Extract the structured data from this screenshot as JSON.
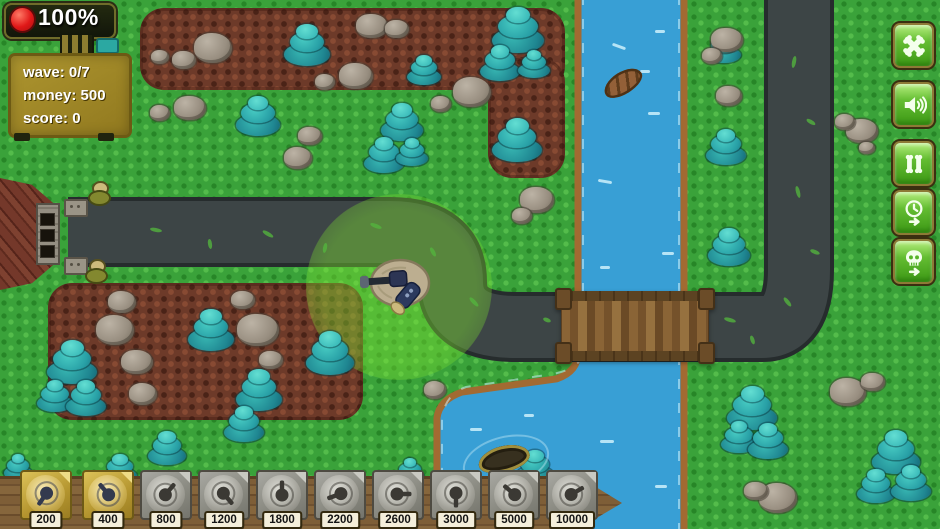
{
  "hud": {
    "health": "100%",
    "stats": [
      "wave: 0/7",
      "money: 500",
      "score: 0"
    ]
  },
  "controls": [
    {
      "id": "settings"
    },
    {
      "id": "sound"
    },
    {
      "id": "pause"
    },
    {
      "id": "fast-forward"
    },
    {
      "id": "next-wave"
    }
  ],
  "shop": {
    "items": [
      {
        "price": "200",
        "affordable": true
      },
      {
        "price": "400",
        "affordable": true
      },
      {
        "price": "800",
        "affordable": false
      },
      {
        "price": "1200",
        "affordable": false
      },
      {
        "price": "1800",
        "affordable": false
      },
      {
        "price": "2200",
        "affordable": false
      },
      {
        "price": "2600",
        "affordable": false
      },
      {
        "price": "3000",
        "affordable": false
      },
      {
        "price": "5000",
        "affordable": false
      },
      {
        "price": "10000",
        "affordable": false
      }
    ]
  },
  "map": {
    "trees": [
      [
        307,
        45,
        46
      ],
      [
        424,
        70,
        34
      ],
      [
        518,
        30,
        52
      ],
      [
        500,
        63,
        40
      ],
      [
        534,
        64,
        32
      ],
      [
        517,
        140,
        50
      ],
      [
        258,
        116,
        44
      ],
      [
        402,
        122,
        42
      ],
      [
        384,
        155,
        40
      ],
      [
        412,
        152,
        32
      ],
      [
        724,
        48,
        34
      ],
      [
        726,
        147,
        40
      ],
      [
        729,
        247,
        42
      ],
      [
        72,
        362,
        50
      ],
      [
        55,
        396,
        36
      ],
      [
        86,
        398,
        40
      ],
      [
        211,
        330,
        46
      ],
      [
        259,
        390,
        46
      ],
      [
        244,
        424,
        40
      ],
      [
        330,
        353,
        48
      ],
      [
        167,
        448,
        38
      ],
      [
        752,
        408,
        50
      ],
      [
        739,
        437,
        36
      ],
      [
        768,
        441,
        40
      ],
      [
        896,
        452,
        48
      ],
      [
        876,
        486,
        38
      ],
      [
        911,
        483,
        40
      ],
      [
        120,
        469,
        34
      ],
      [
        18,
        467,
        28
      ],
      [
        410,
        471,
        28
      ],
      [
        535,
        467,
        38
      ]
    ],
    "rocks": [
      [
        213,
        48,
        38
      ],
      [
        184,
        60,
        24
      ],
      [
        160,
        57,
        18
      ],
      [
        372,
        26,
        32
      ],
      [
        397,
        29,
        24
      ],
      [
        356,
        76,
        34
      ],
      [
        325,
        82,
        20
      ],
      [
        472,
        92,
        38
      ],
      [
        441,
        104,
        20
      ],
      [
        190,
        108,
        32
      ],
      [
        160,
        113,
        20
      ],
      [
        310,
        136,
        24
      ],
      [
        298,
        158,
        28
      ],
      [
        122,
        302,
        28
      ],
      [
        115,
        330,
        38
      ],
      [
        137,
        362,
        32
      ],
      [
        143,
        394,
        28
      ],
      [
        258,
        330,
        42
      ],
      [
        271,
        360,
        24
      ],
      [
        243,
        300,
        24
      ],
      [
        727,
        40,
        32
      ],
      [
        712,
        56,
        20
      ],
      [
        729,
        96,
        26
      ],
      [
        862,
        131,
        32
      ],
      [
        845,
        122,
        20
      ],
      [
        867,
        148,
        16
      ],
      [
        537,
        200,
        34
      ],
      [
        522,
        216,
        20
      ],
      [
        435,
        390,
        22
      ],
      [
        848,
        392,
        36
      ],
      [
        873,
        382,
        24
      ],
      [
        778,
        498,
        38
      ],
      [
        756,
        491,
        24
      ]
    ],
    "road_marks": [
      [
        150,
        228,
        12,
        10
      ],
      [
        205,
        242,
        10,
        80
      ],
      [
        262,
        232,
        12,
        30
      ],
      [
        320,
        246,
        10,
        100
      ],
      [
        370,
        224,
        12,
        20
      ],
      [
        428,
        250,
        10,
        60
      ],
      [
        468,
        300,
        12,
        45
      ],
      [
        543,
        318,
        8,
        20
      ],
      [
        724,
        318,
        12,
        15
      ],
      [
        748,
        338,
        9,
        70
      ],
      [
        788,
        60,
        12,
        100
      ],
      [
        806,
        120,
        10,
        30
      ],
      [
        792,
        190,
        12,
        75
      ],
      [
        810,
        250,
        10,
        20
      ],
      [
        782,
        300,
        11,
        50
      ]
    ],
    "water_dashes": [
      [
        612,
        45,
        14,
        20
      ],
      [
        648,
        112,
        12,
        0
      ],
      [
        598,
        180,
        14,
        10
      ],
      [
        662,
        252,
        12,
        0
      ],
      [
        600,
        266,
        10,
        0
      ],
      [
        640,
        70,
        10,
        0
      ],
      [
        655,
        30,
        10,
        0
      ],
      [
        470,
        428,
        12,
        0
      ],
      [
        524,
        414,
        10,
        0
      ],
      [
        600,
        440,
        14,
        0
      ],
      [
        655,
        485,
        12,
        0
      ],
      [
        590,
        502,
        10,
        0
      ]
    ]
  },
  "colors": {
    "grass": "#3aa23a",
    "dirt": "#6d3a29",
    "water": "#389fd5",
    "road": "#3d4546",
    "bank": "#a26a32",
    "button_green": "#64bd32",
    "card_gold": "#b4952f",
    "range_green": "#7de130",
    "health_red": "#e01818"
  }
}
